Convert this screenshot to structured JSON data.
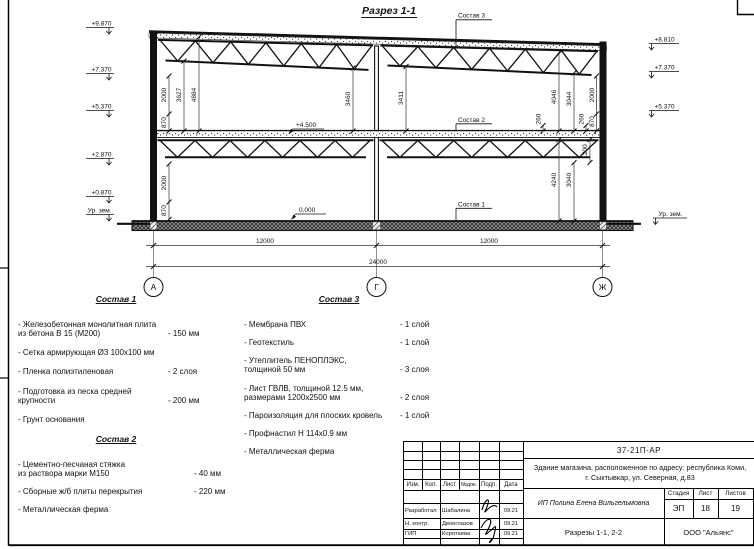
{
  "drawing": {
    "title": "Разрез 1-1",
    "leaders": {
      "s1": "Состав 1",
      "s2": "Состав 2",
      "s3": "Состав 3"
    },
    "elev": {
      "l1": "+9.870",
      "l2": "+7.370",
      "l3": "+5.370",
      "l4": "+2.870",
      "l5": "+0.870",
      "l6": "Ур. зем.",
      "r1": "+8.810",
      "r2": "+7.370",
      "r3": "+5.370",
      "r4": "Ур. зем.",
      "floor": "+4.500",
      "zero": "0.000"
    },
    "dims": {
      "v870_ul": "870",
      "v2000_ul": "2000",
      "v3627": "3627",
      "v4884": "4884",
      "v3460": "3460",
      "v3411": "3411",
      "v260_a": "260",
      "v4046": "4046",
      "v3044": "3044",
      "v260_b": "260",
      "v870_ur": "870",
      "v2000_ur": "2000",
      "v2000_ll": "2000",
      "v870_ll": "870",
      "v4240": "4240",
      "v3040": "3040",
      "v1200": "1200",
      "h12000_a": "12000",
      "h12000_b": "12000",
      "h24000": "24000"
    },
    "axes": {
      "a": "А",
      "g": "Г",
      "j": "Ж"
    }
  },
  "compositions": [
    {
      "header": "Состав 1",
      "items": [
        {
          "name": "- Железобетонная  монолитная плита\nиз бетона В 15 (М200)",
          "value": "- 150 мм"
        },
        {
          "name": "- Сетка армирующая Ø3 100х100 мм",
          "value": ""
        },
        {
          "name": "- Пленка полиэтиленовая",
          "value": "-  2 слоя"
        },
        {
          "name": "- Подготовка из песка средней\nкрупности",
          "value": "- 200 мм"
        },
        {
          "name": "- Грунт основания",
          "value": ""
        }
      ]
    },
    {
      "header": "Состав 2",
      "items": [
        {
          "name": "- Цементно-песчаная стяжка\nиз раствора марки М150",
          "value": "- 40 мм"
        },
        {
          "name": "- Сборные ж/б плиты перекрытия",
          "value": "- 220 мм"
        },
        {
          "name": "- Металлическая ферма",
          "value": ""
        }
      ]
    },
    {
      "header": "Состав 3",
      "items": [
        {
          "name": "- Мембрана ПВХ",
          "value": "- 1 слой"
        },
        {
          "name": "- Геотекстиль",
          "value": "- 1 слой"
        },
        {
          "name": "- Утеплитель ПЕНОПЛЭКС,\nтолщиной 50 мм",
          "value": "- 3 слоя"
        },
        {
          "name": "- Лист ГВЛВ, толщиной 12.5 мм,\nразмерами 1200х2500 мм",
          "value": "- 2 слоя"
        },
        {
          "name": "- Пароизоляция для плоских кровель",
          "value": "- 1 слой"
        },
        {
          "name": "- Профнастил Н 114х0.9 мм",
          "value": ""
        },
        {
          "name": "- Металлическая ферма",
          "value": ""
        }
      ]
    }
  ],
  "titleblock": {
    "code": "37-21П-АР",
    "object_line1": "Здание магазина, расположенное по адресу: республика Коми,",
    "object_line2": "г. Сыктывкар, ул. Северная, д.83",
    "client": "ИП Полина Елена Вильгельмовна",
    "sheet_title": "Разрезы 1-1, 2-2",
    "company": "ООО \"Альянс\"",
    "stage_label": "Стадия",
    "sheet_label": "Лист",
    "sheets_label": "Листов",
    "stage": "ЭП",
    "sheet": "18",
    "sheets": "19",
    "rev_headers": [
      "Изм.",
      "Кол.",
      "Лист",
      "№док.",
      "Подп.",
      "Дата"
    ],
    "rows": [
      {
        "role": "Разработал",
        "name": "Шабалина",
        "date": "09.21"
      },
      {
        "role": "Н. контр.",
        "name": "Двоеглазов",
        "date": "09.21"
      },
      {
        "role": "ГИП",
        "name": "Коротаева",
        "date": "09.21"
      }
    ]
  }
}
